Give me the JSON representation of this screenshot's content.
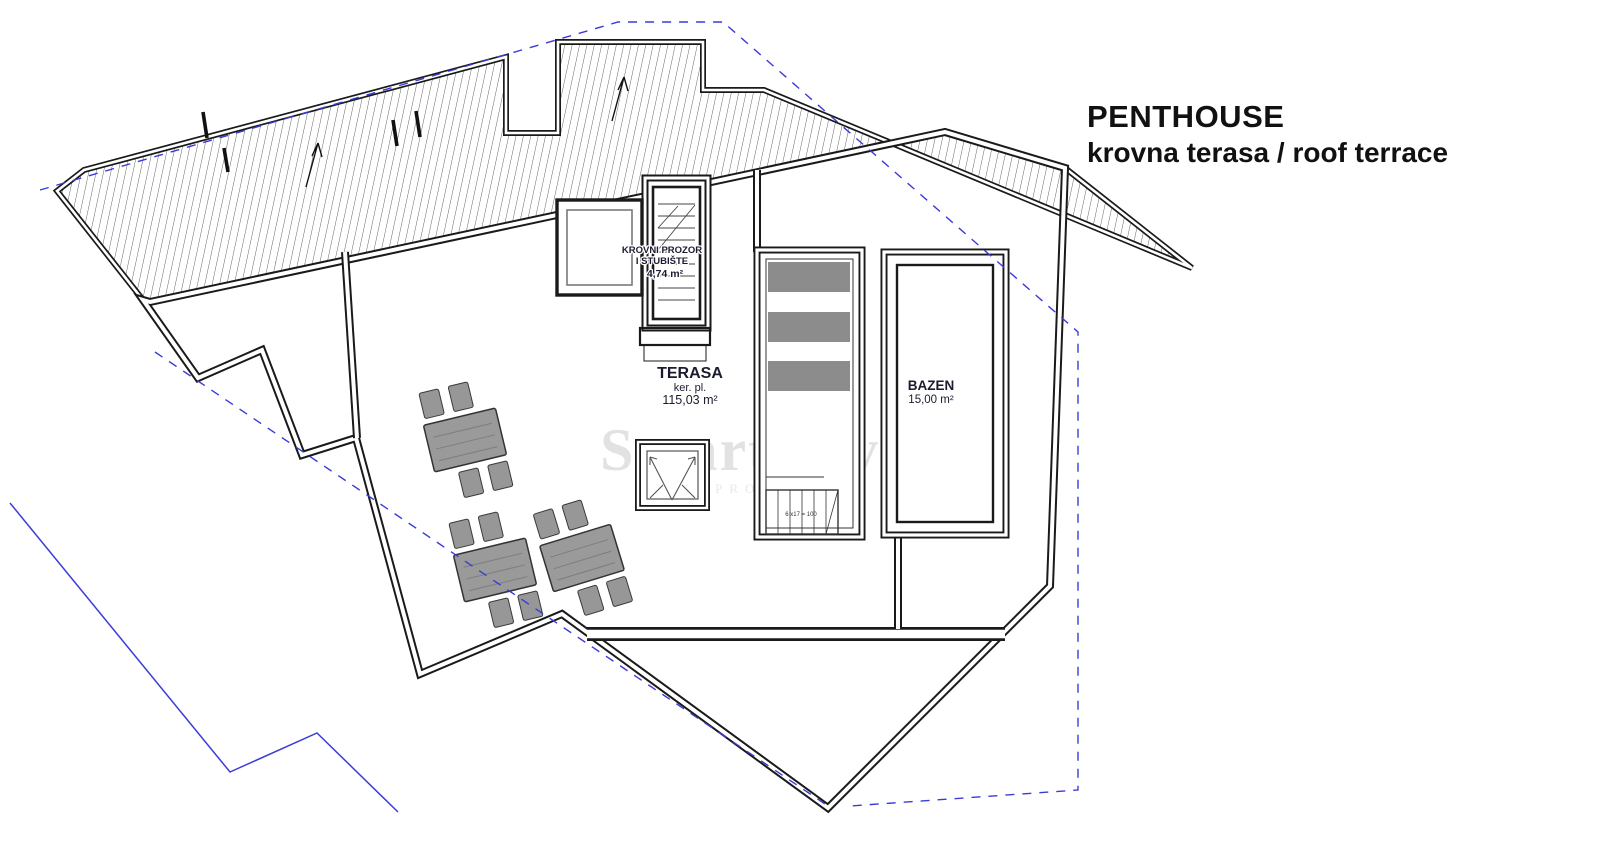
{
  "title": {
    "line1": "PENTHOUSE",
    "line2": "krovna terasa / roof terrace"
  },
  "labels": {
    "stairwell": {
      "line1": "KROVNI PROZOR",
      "line2": "I STUBIŠTE",
      "area": "4,74 m²"
    },
    "terrace": {
      "name": "TERASA",
      "sub": "ker. pl.",
      "area": "115,03 m²"
    },
    "pool": {
      "name": "BAZEN",
      "area": "15,00 m²"
    },
    "stair_dimension": "6 x17 = 100"
  },
  "watermark": {
    "initial": "S",
    "name": "Smart Invest",
    "reg": "®",
    "sub": "PROPERTIES"
  },
  "colors": {
    "wall_black": "#1a1a1a",
    "hatch_gray": "#555555",
    "boundary_blue": "#3b3bd8",
    "furniture_gray": "#979797",
    "lounger_gray": "#8c8c8c",
    "watermark_gray": "#cccccc",
    "label_navy": "#1b1b30",
    "title_black": "#111111"
  }
}
